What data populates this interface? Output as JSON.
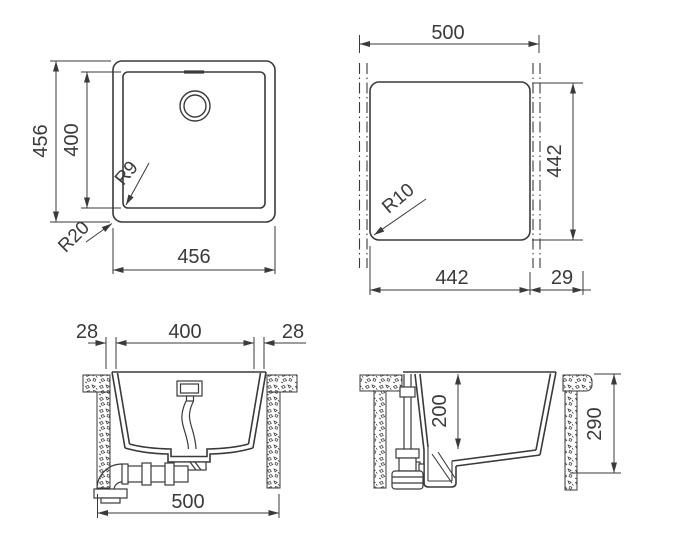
{
  "meta": {
    "background": "#ffffff",
    "line_color": "#3a3a3a"
  },
  "views": {
    "plan": {
      "height_outer": "456",
      "height_inner": "400",
      "width_bottom": "456",
      "radius_inner": "R9",
      "radius_outer": "R20"
    },
    "cutout": {
      "width_top": "500",
      "height_right": "442",
      "width_bottom": "442",
      "offset_right": "29",
      "radius_corner": "R10"
    },
    "front_section": {
      "overhang_left": "28",
      "width_inner": "400",
      "overhang_right": "28",
      "width_total": "500"
    },
    "side_section": {
      "depth_bowl": "200",
      "depth_total": "290"
    }
  }
}
